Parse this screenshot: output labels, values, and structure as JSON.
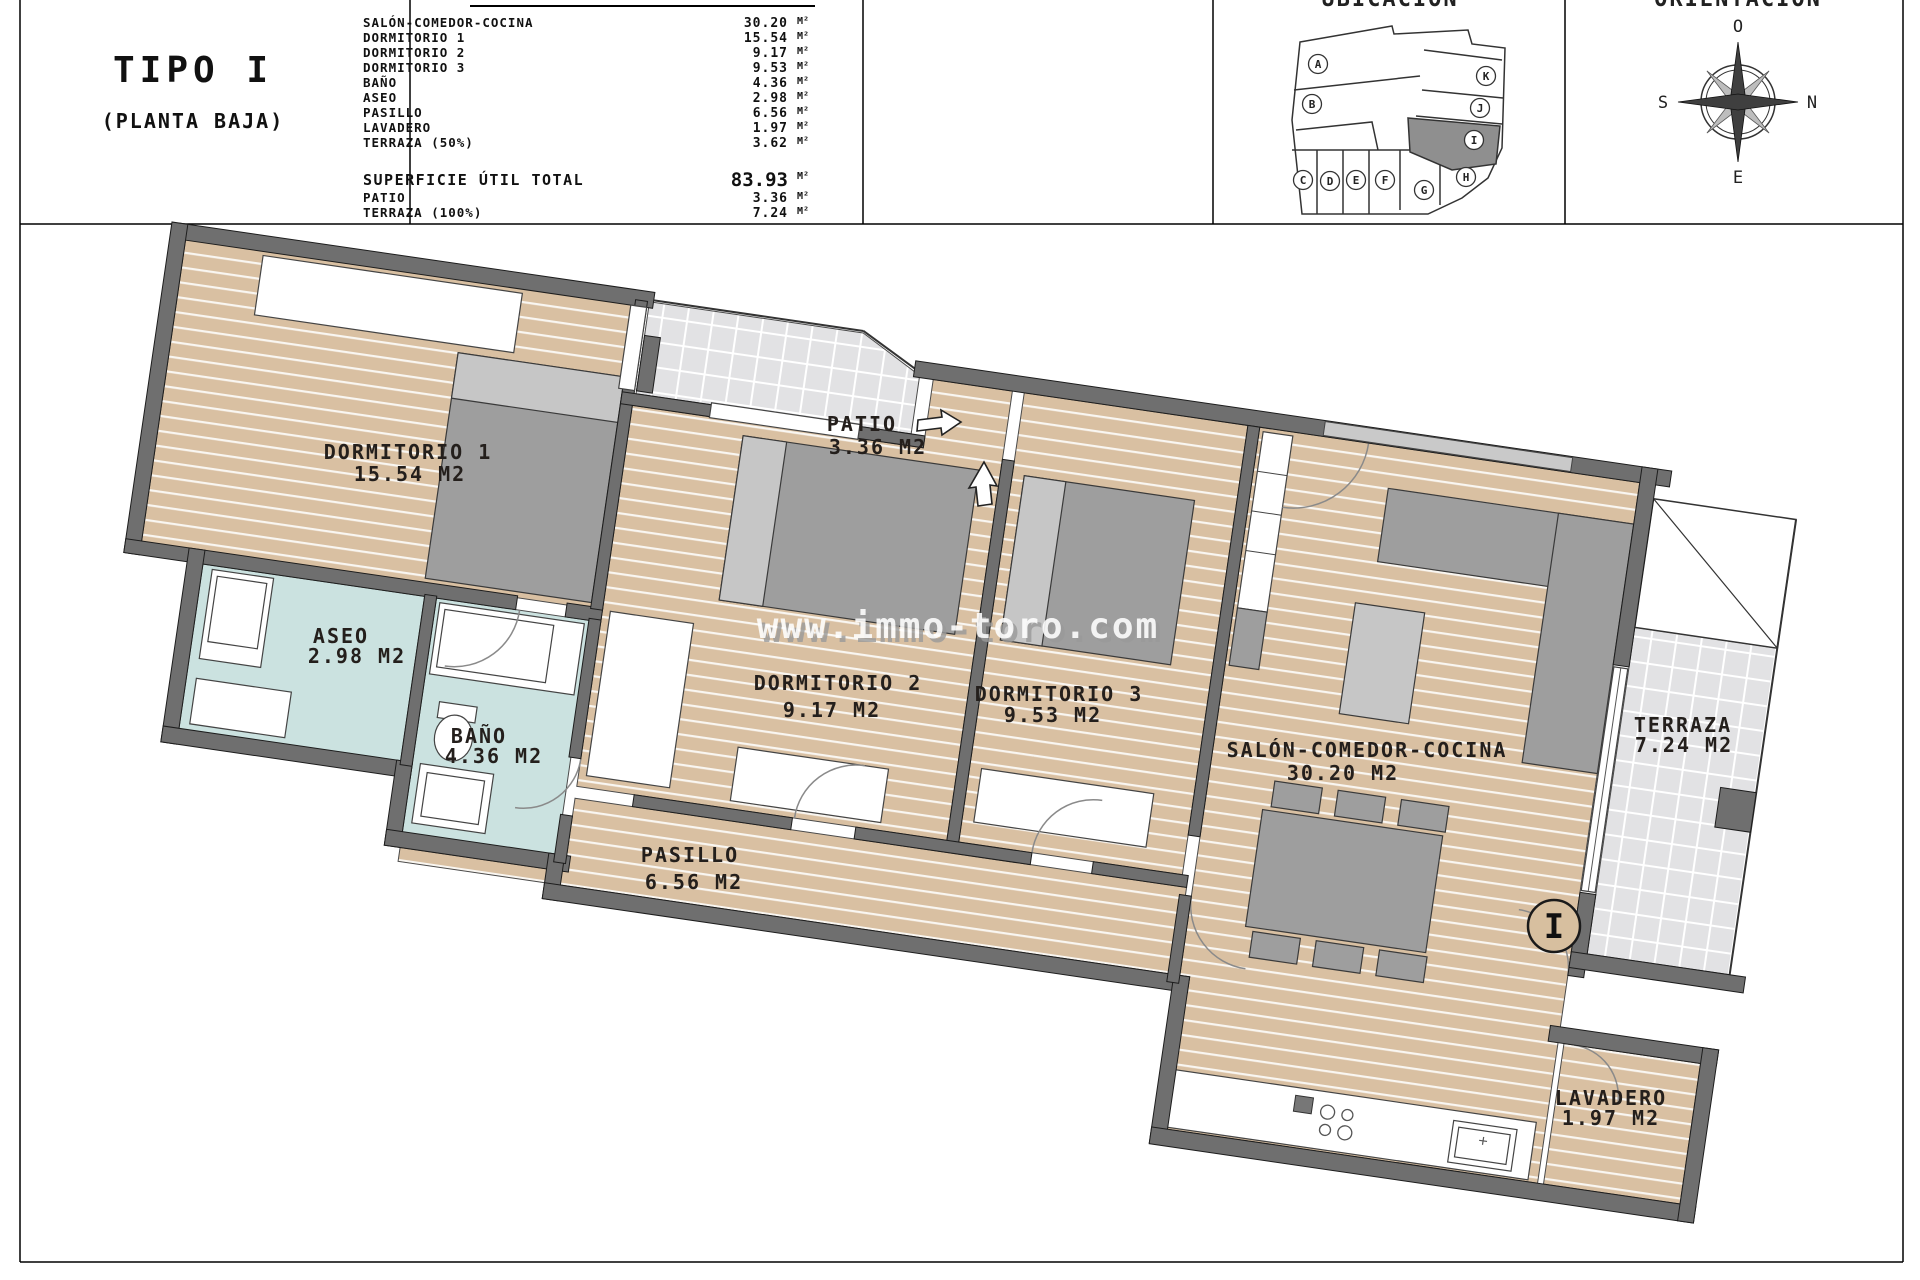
{
  "sheet": {
    "title": "TIPO I",
    "subtitle": "(PLANTA BAJA)"
  },
  "area_table": {
    "unit": "M²",
    "rows": [
      {
        "label": "SALÓN-COMEDOR-COCINA",
        "value": "30.20"
      },
      {
        "label": "DORMITORIO 1",
        "value": "15.54"
      },
      {
        "label": "DORMITORIO 2",
        "value": "9.17"
      },
      {
        "label": "DORMITORIO 3",
        "value": "9.53"
      },
      {
        "label": "BAÑO",
        "value": "4.36"
      },
      {
        "label": "ASEO",
        "value": "2.98"
      },
      {
        "label": "PASILLO",
        "value": "6.56"
      },
      {
        "label": "LAVADERO",
        "value": "1.97"
      },
      {
        "label": "TERRAZA (50%)",
        "value": "3.62"
      }
    ],
    "total": {
      "label": "SUPERFICIE ÚTIL TOTAL",
      "value": "83.93"
    },
    "extra_rows": [
      {
        "label": "PATIO",
        "value": "3.36"
      },
      {
        "label": "TERRAZA (100%)",
        "value": "7.24"
      }
    ]
  },
  "location": {
    "title": "UBICACIÓN",
    "highlighted_unit": "I",
    "units": [
      "A",
      "B",
      "C",
      "D",
      "E",
      "F",
      "G",
      "H",
      "I",
      "J",
      "K"
    ]
  },
  "compass": {
    "title": "ORIENTACIÓN",
    "top": "O",
    "right": "N",
    "left": "S",
    "bottom": "E"
  },
  "watermark": "www.immo-toro.com",
  "plan": {
    "unit_marker": "I",
    "rooms": {
      "dorm1": {
        "name": "DORMITORIO 1",
        "area": "15.54 M2"
      },
      "dorm2": {
        "name": "DORMITORIO 2",
        "area": "9.17 M2"
      },
      "dorm3": {
        "name": "DORMITORIO 3",
        "area": "9.53 M2"
      },
      "salon": {
        "name": "SALÓN-COMEDOR-COCINA",
        "area": "30.20 M2"
      },
      "bano": {
        "name": "BAÑO",
        "area": "4.36 M2"
      },
      "aseo": {
        "name": "ASEO",
        "area": "2.98 M2"
      },
      "pasillo": {
        "name": "PASILLO",
        "area": "6.56 M2"
      },
      "patio": {
        "name": "PATIO",
        "area": "3.36 M2"
      },
      "terraza": {
        "name": "TERRAZA",
        "area": "7.24 M2"
      },
      "lavadero": {
        "name": "LAVADERO",
        "area": "1.97 M2"
      }
    }
  },
  "colors": {
    "wood_floor": "#d9c0a2",
    "wet_room": "#cbe2e0",
    "tile_floor": "#e2e2e4",
    "wall": "#6f6f6f",
    "highlight_unit": "#8f8f8f"
  }
}
